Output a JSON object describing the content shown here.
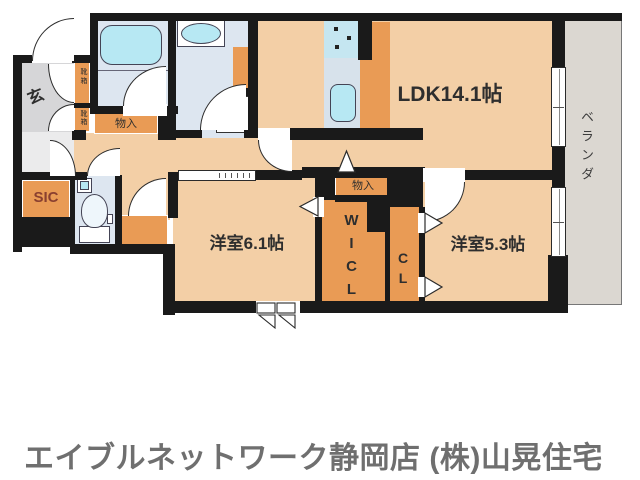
{
  "floorplan": {
    "labels": {
      "ldk": "LDK14.1帖",
      "bedroom1": "洋室6.1帖",
      "bedroom2": "洋室5.3帖",
      "wicl": "WICL",
      "cl": "CL",
      "genkan": "玄",
      "sic": "SIC",
      "veranda": "ベランダ",
      "storage_hall": "物入",
      "storage_ldk": "物入",
      "shoebox_upper": "靴箱",
      "shoebox_lower": "靴箱"
    },
    "colors": {
      "room_floor": "#f3cfa6",
      "closet_orange": "#e99b55",
      "wet_room_blue": "#dde6f0",
      "fixture_cyan": "#b7e8f3",
      "veranda_gray": "#dbd7d1",
      "genkan_gray": "#d6d6d8",
      "wall_black": "#1a1a1a",
      "label_text": "#2e2e2e",
      "sic_text": "#8a4030",
      "footer_text": "#6f6f6f"
    }
  },
  "footer": {
    "text": "エイブルネットワーク静岡店 (株)山晃住宅"
  }
}
